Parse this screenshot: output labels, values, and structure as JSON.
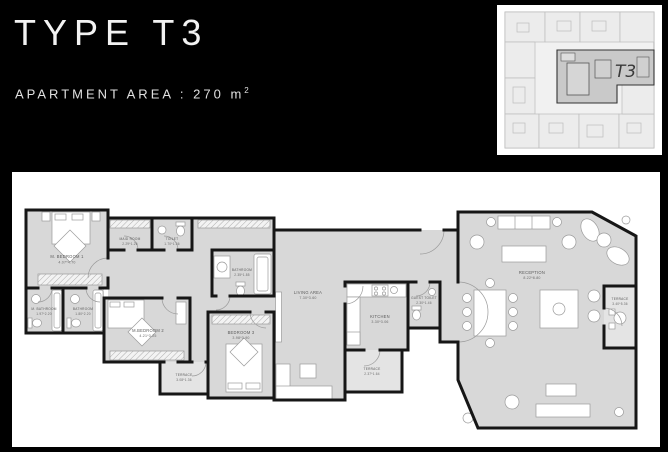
{
  "header": {
    "title": "TYPE T3",
    "area_label": "APARTMENT AREA : 270 m",
    "area_superscript": "2"
  },
  "key_plan": {
    "unit_label": "T3"
  },
  "colors": {
    "background": "#000000",
    "panel": "#ffffff",
    "room_fill": "#d8d8d8",
    "terrace_fill": "#e4e4e4",
    "wall": "#161616"
  },
  "floor_plan": {
    "rooms": [
      {
        "name": "M. BEDROOM 1",
        "dims": "4.07*4.70"
      },
      {
        "name": "MAID ROOM",
        "dims": "2.29*1.26"
      },
      {
        "name": "TOILET",
        "dims": "1.70*1.36"
      },
      {
        "name": "M. BATHROOM",
        "dims": "1.97*2.20"
      },
      {
        "name": "BATHROOM",
        "dims": "1.80*2.20"
      },
      {
        "name": "M.BEDROOM 2",
        "dims": "4.21*3.25"
      },
      {
        "name": "TERRACE",
        "dims": "3.08*1.36"
      },
      {
        "name": "BEDROOM 3",
        "dims": "3.98*3.90"
      },
      {
        "name": "BATHROOM",
        "dims": "2.35*1.85"
      },
      {
        "name": "LIVING AREA",
        "dims": "7.30*3.60"
      },
      {
        "name": "KITCHEN",
        "dims": "3.30*3.06"
      },
      {
        "name": "GUEST TOILET",
        "dims": "2.30*1.46"
      },
      {
        "name": "TERRACE",
        "dims": "2.37*1.64"
      },
      {
        "name": "RECEPTION",
        "dims": "8.22*8.80"
      },
      {
        "name": "TERRACE",
        "dims": "3.40*5.36"
      }
    ]
  }
}
